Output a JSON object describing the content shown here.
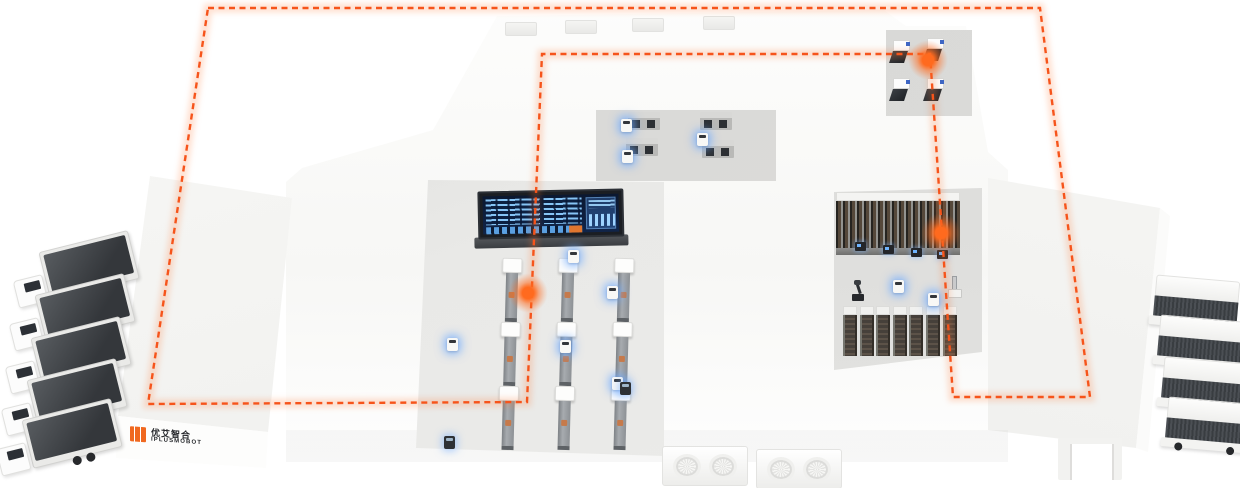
{
  "logo": {
    "text_cn": "优艾智合",
    "text_en": "IPLUSMOBOT"
  },
  "colors": {
    "accent_orange": "#f6541b",
    "glow_orange": "#ff6a1e",
    "building_white": "#ffffff",
    "roof_light": "#f3f3f1",
    "floor_gray": "#e4e4e2",
    "screen_bg": "#102449",
    "screen_blue": "#8ccdff",
    "truck_dark": "#3c4043"
  },
  "route": {
    "style": "dashed-loop",
    "color": "#f6541b",
    "loop_points": [
      [
        208,
        8
      ],
      [
        1040,
        8
      ],
      [
        1090,
        397
      ],
      [
        953,
        397
      ],
      [
        930,
        54
      ],
      [
        542,
        54
      ],
      [
        527,
        402
      ],
      [
        148,
        404
      ]
    ],
    "stations": [
      {
        "x": 928,
        "y": 60
      },
      {
        "x": 941,
        "y": 233
      },
      {
        "x": 528,
        "y": 293
      }
    ]
  },
  "fleet": {
    "trucks_left": 5,
    "trucks_right": 4
  },
  "equipment": {
    "assembly_lines": 3,
    "stations_per_line": 3,
    "test_benches": 4,
    "cnc_machines": 4,
    "buffer_racks": 7,
    "storage_rack_bays": 14,
    "agvs_visible": 12
  }
}
